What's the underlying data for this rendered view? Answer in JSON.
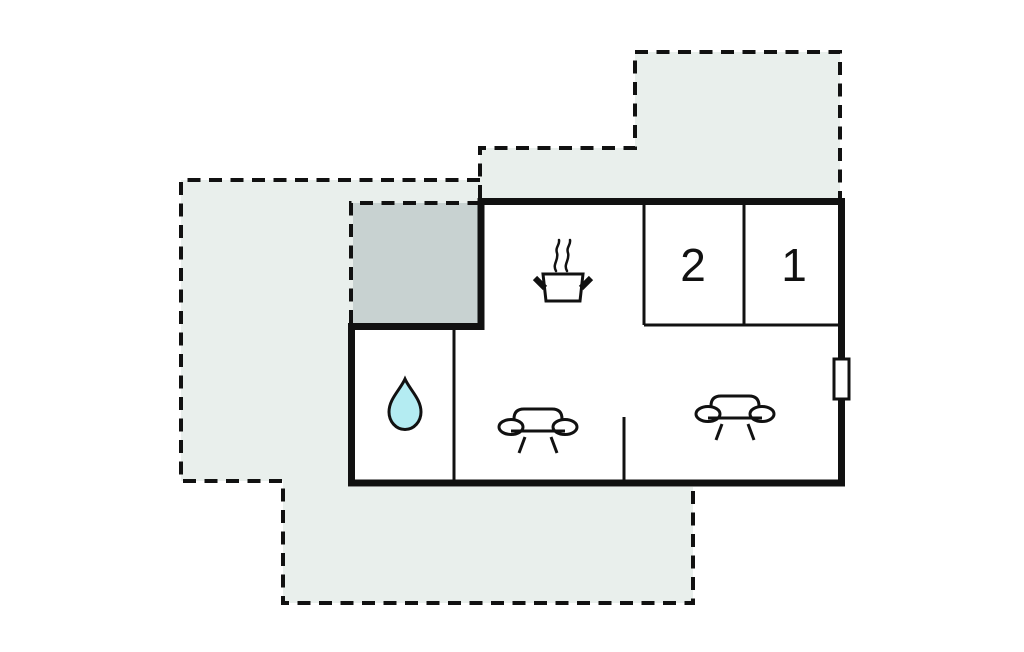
{
  "colors": {
    "wall": "#111111",
    "terrace-light": "#e9efec",
    "terrace-dark": "#c8d2d1",
    "water-drop": "#b4ecf2",
    "background": "#ffffff"
  },
  "floorplan": {
    "rooms": [
      {
        "label": "2"
      },
      {
        "label": "1"
      }
    ],
    "icons": [
      "stove-pot-icon",
      "water-drop-icon",
      "sofa-icon",
      "sofa-icon",
      "window-marker"
    ]
  }
}
